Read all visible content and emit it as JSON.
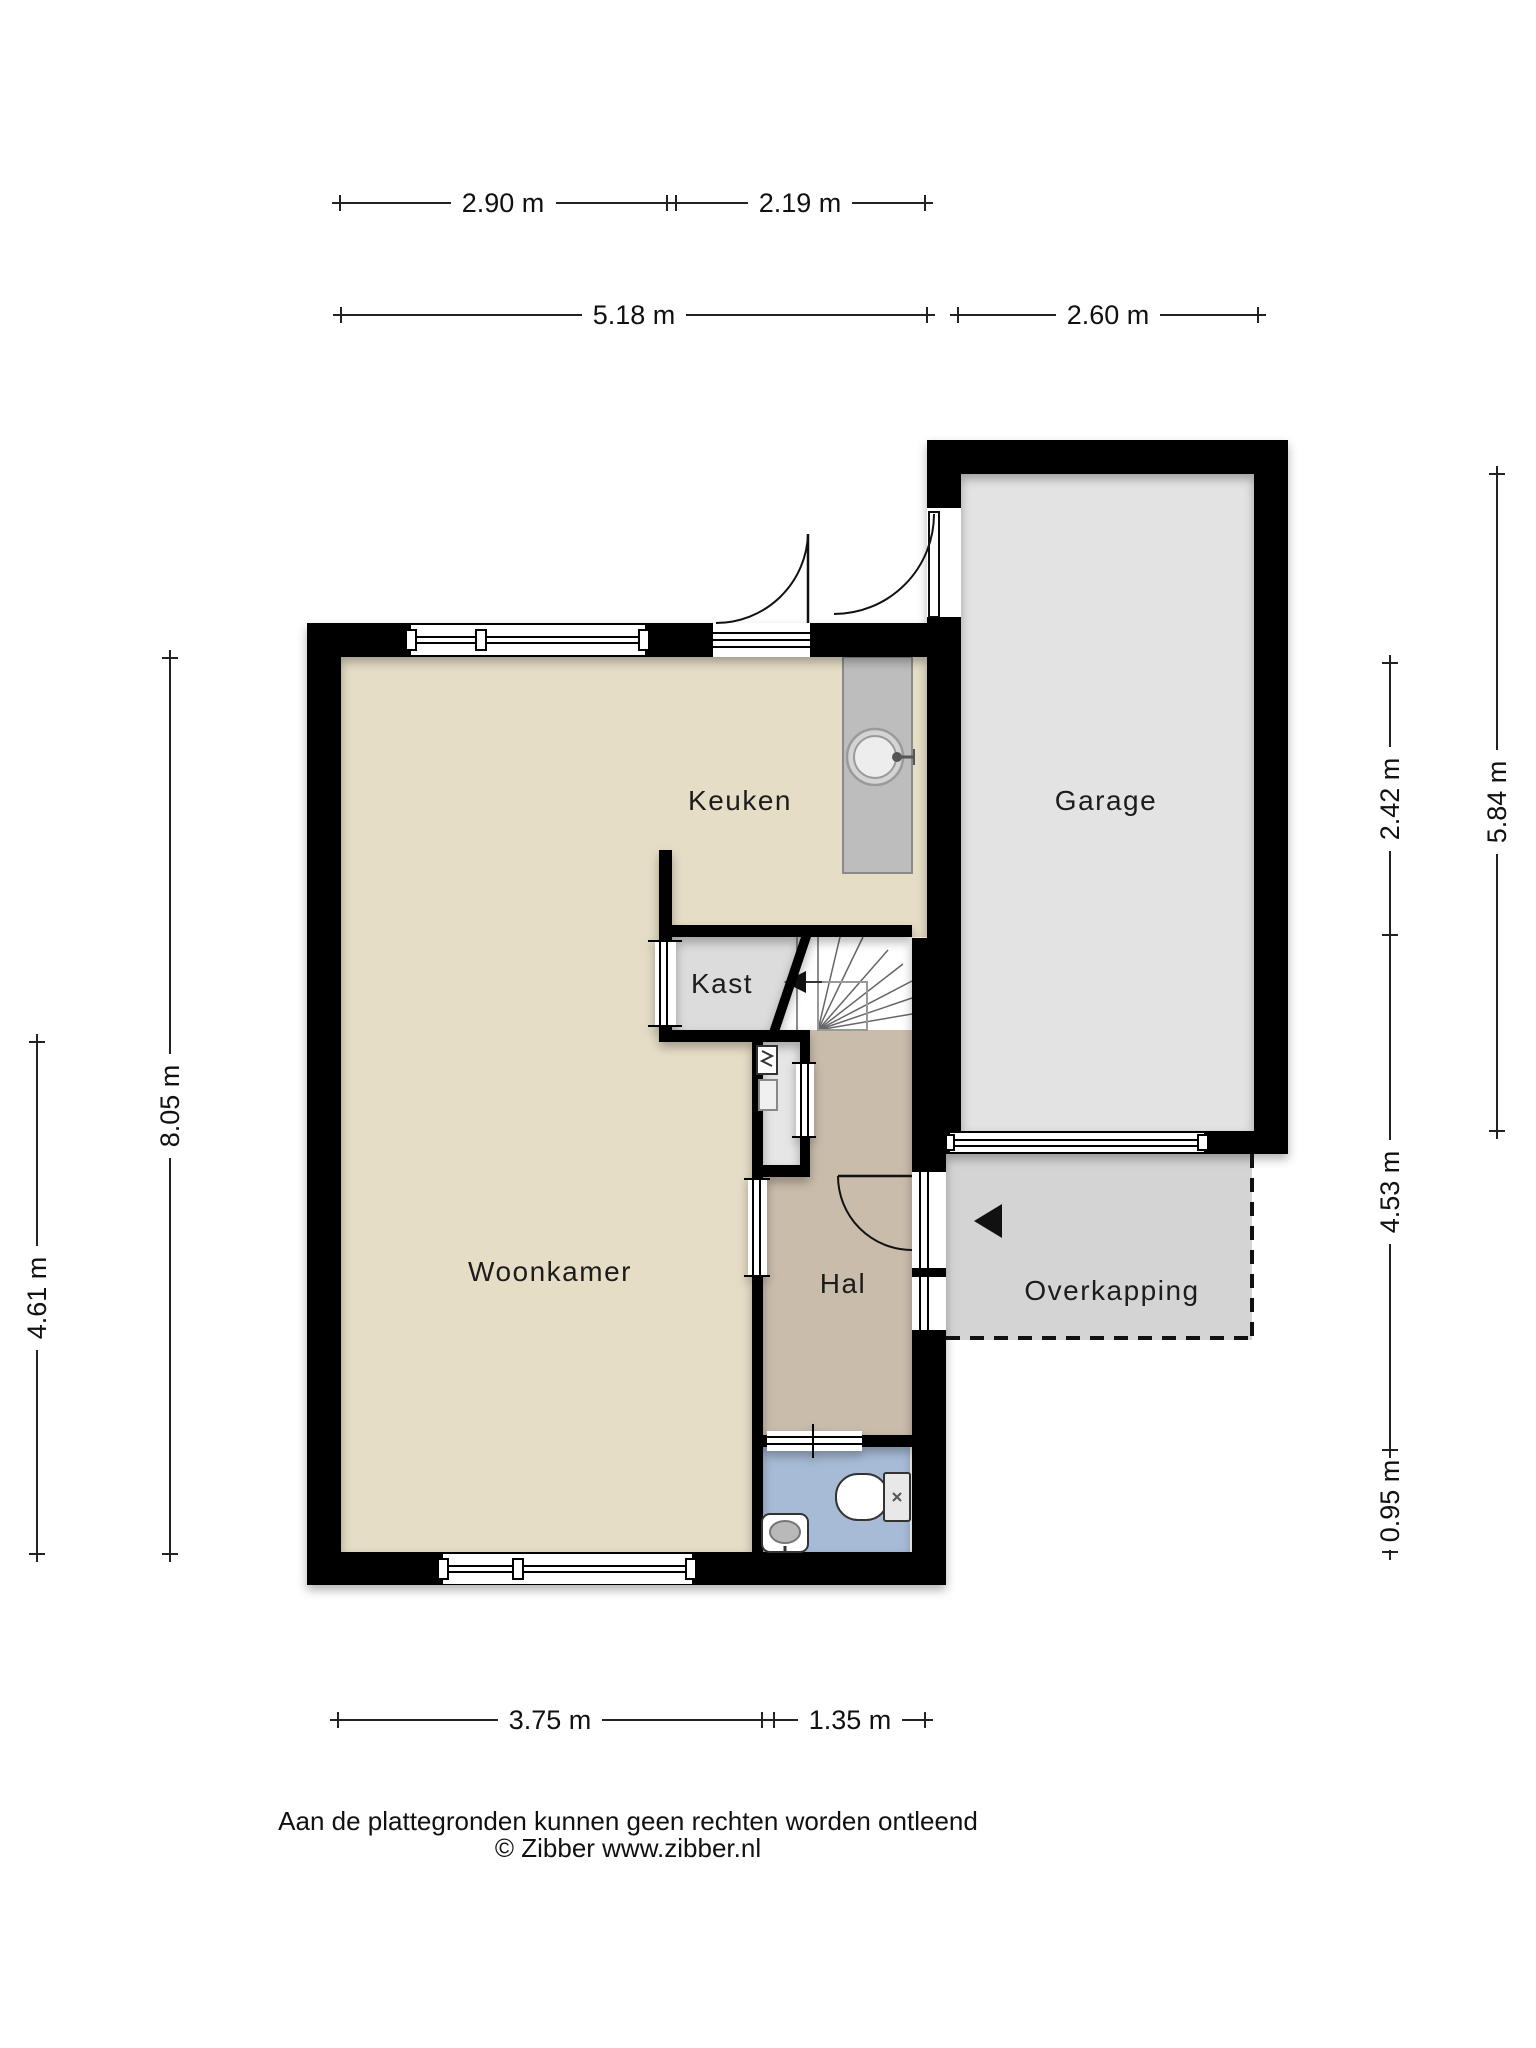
{
  "rooms": {
    "keuken": {
      "label": "Keuken"
    },
    "garage": {
      "label": "Garage"
    },
    "kast": {
      "label": "Kast"
    },
    "woonkamer": {
      "label": "Woonkamer"
    },
    "hal": {
      "label": "Hal"
    },
    "overkapping": {
      "label": "Overkapping"
    }
  },
  "dimensions": {
    "row1": [
      {
        "label": "2.90 m"
      },
      {
        "label": "2.19 m"
      }
    ],
    "row2": [
      {
        "label": "5.18 m"
      },
      {
        "label": "2.60 m"
      }
    ],
    "left": [
      {
        "label": "8.05 m"
      },
      {
        "label": "4.61 m"
      }
    ],
    "right": [
      {
        "label": "2.42 m"
      },
      {
        "label": "5.84 m"
      },
      {
        "label": "4.53 m"
      },
      {
        "label": "0.95 m"
      }
    ],
    "bottom": [
      {
        "label": "3.75 m"
      },
      {
        "label": "1.35 m"
      }
    ]
  },
  "footer": {
    "line1": "Aan de plattegronden kunnen geen rechten worden ontleend",
    "line2": "© Zibber www.zibber.nl"
  },
  "colors": {
    "wall": "#000000",
    "floor_living": "#e5ddc5",
    "floor_hall": "#c9bcab",
    "floor_toilet": "#a7bbd7",
    "floor_closet": "#dcdcdc",
    "floor_meter": "#e6e6e6",
    "floor_garage": "#e3e3e3",
    "floor_canopy": "#d4d4d4",
    "counter": "#bdbdbd"
  },
  "icons": {
    "sink": "kitchen-sink-icon",
    "toilet": "toilet-icon",
    "washbasin": "washbasin-icon",
    "meter": "meter-cabinet-icon",
    "stairs_arrow": "stairs-direction-arrow-icon",
    "entrance_arrow": "entrance-arrow-icon"
  }
}
